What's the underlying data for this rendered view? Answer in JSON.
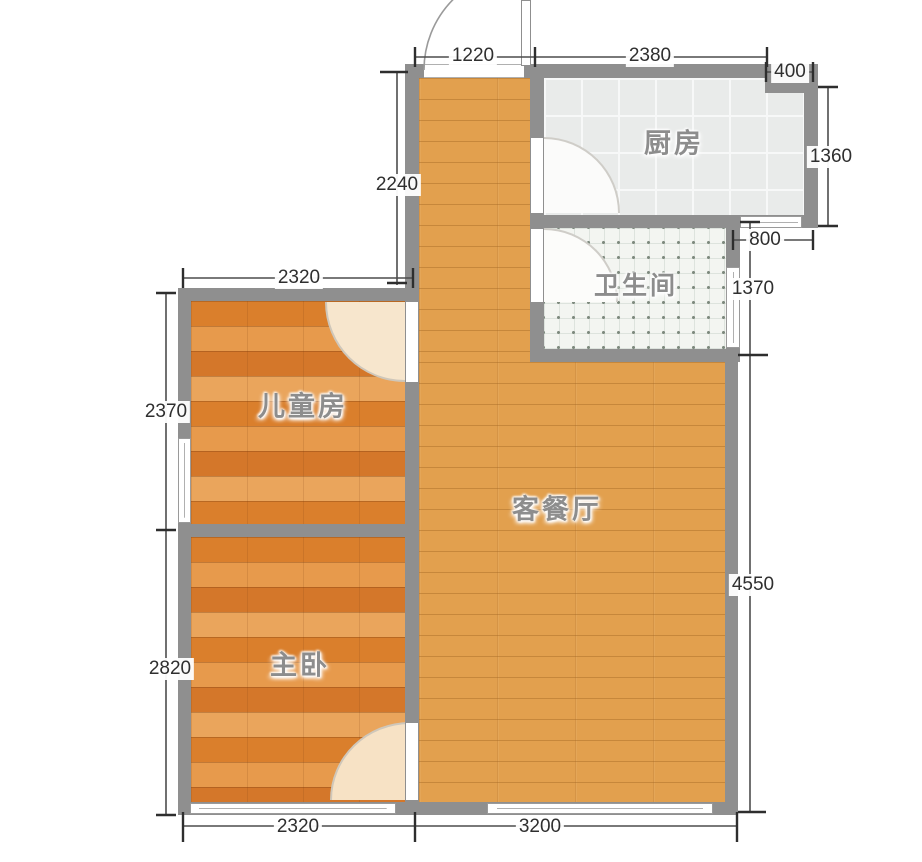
{
  "rooms": {
    "kitchen": {
      "label": "厨房"
    },
    "bathroom": {
      "label": "卫生间"
    },
    "living_dining": {
      "label": "客餐厅"
    },
    "kids_room": {
      "label": "儿童房"
    },
    "master_bedroom": {
      "label": "主卧"
    }
  },
  "dims": {
    "entry_width": "1220",
    "kitchen_width": "2380",
    "kitchen_corner": "400",
    "kitchen_depth": "1360",
    "kitchen_overhang": "800",
    "bathroom_depth": "1370",
    "living_right_height": "4550",
    "hall_left_height": "2240",
    "kids_width_top": "2320",
    "kids_height": "2370",
    "master_height": "2820",
    "master_width_bottom": "2320",
    "living_width_bottom": "3200"
  },
  "colors": {
    "wall": "#8f8f8f",
    "wood_living": "#e2a04e",
    "wood_bedroom": "#e08a38",
    "kitchen_tile": "#e9ebea",
    "bath_tile": "#f3f5f1",
    "door_swing": "#f7e6cd",
    "dimension_text": "#2f2f2f",
    "room_label_text": "#8d8d8d"
  }
}
